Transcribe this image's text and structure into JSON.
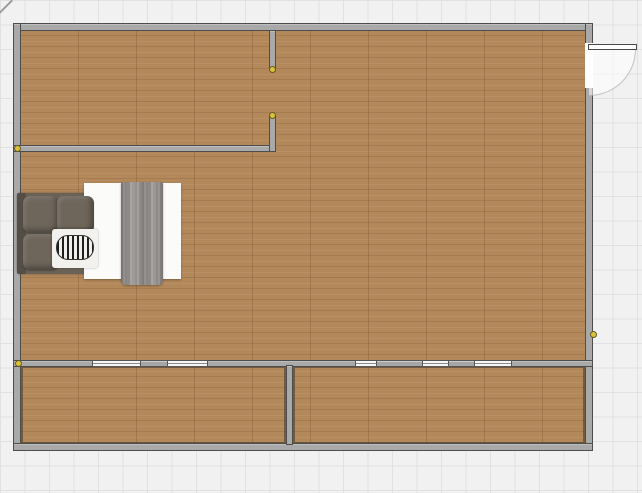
{
  "canvas": {
    "width": 642,
    "height": 493,
    "grid_size": 24.5
  },
  "colors": {
    "grid_bg": "#f1f1f1",
    "grid_line": "#e1e1e1",
    "floor": "#b3885a",
    "wall": "#a9a9a9",
    "wall_outline": "#4d4d4d",
    "window_glass": "#f6f6f6",
    "window_frame": "#565656",
    "window_panel": "#a6a6a6",
    "door_white": "#ffffff",
    "swing": "rgba(255,255,255,0.55)",
    "dot_fill": "#d8c33c",
    "dot_ring": "#6a5a1d",
    "room_outline": "rgba(64,52,36,0.55)",
    "mattress": "#fbfbfa",
    "bed_base": "#6b6257",
    "headboard": "#554e47",
    "pillow": "#6f665b",
    "blanket": "#979390"
  },
  "plan": {
    "floor": {
      "x": 20,
      "y": 30,
      "w": 566,
      "h": 414
    },
    "room_outlines": [
      {
        "x": 21,
        "y": 366,
        "w": 265,
        "h": 78
      },
      {
        "x": 293,
        "y": 366,
        "w": 292,
        "h": 78
      }
    ],
    "walls": [
      {
        "name": "wall-outer-top",
        "x": 13,
        "y": 23,
        "w": 580,
        "h": 8
      },
      {
        "name": "wall-outer-left",
        "x": 13,
        "y": 23,
        "w": 8,
        "h": 428
      },
      {
        "name": "wall-outer-right",
        "x": 585,
        "y": 23,
        "w": 8,
        "h": 428
      },
      {
        "name": "wall-outer-bottom",
        "x": 13,
        "y": 443,
        "w": 580,
        "h": 8
      },
      {
        "name": "wall-partition-top-room",
        "x": 13,
        "y": 145,
        "w": 263,
        "h": 7
      },
      {
        "name": "wall-partition-vertical-upper",
        "x": 269,
        "y": 30,
        "w": 7,
        "h": 40
      },
      {
        "name": "wall-partition-vertical-lower",
        "x": 269,
        "y": 115,
        "w": 7,
        "h": 37
      },
      {
        "name": "wall-window-horizontal",
        "x": 13,
        "y": 360,
        "w": 580,
        "h": 7
      },
      {
        "name": "wall-divider-bottom",
        "x": 286,
        "y": 365,
        "w": 7,
        "h": 80
      }
    ],
    "windows": [
      {
        "x": 92,
        "y": 360,
        "w": 49,
        "h": 7,
        "kind": "glass"
      },
      {
        "x": 140,
        "y": 360,
        "w": 28,
        "h": 7,
        "kind": "panel"
      },
      {
        "x": 167,
        "y": 360,
        "w": 41,
        "h": 7,
        "kind": "glass"
      },
      {
        "x": 355,
        "y": 360,
        "w": 22,
        "h": 7,
        "kind": "glass"
      },
      {
        "x": 376,
        "y": 360,
        "w": 47,
        "h": 7,
        "kind": "panel"
      },
      {
        "x": 422,
        "y": 360,
        "w": 27,
        "h": 7,
        "kind": "glass"
      },
      {
        "x": 448,
        "y": 360,
        "w": 27,
        "h": 7,
        "kind": "panel"
      },
      {
        "x": 474,
        "y": 360,
        "w": 38,
        "h": 7,
        "kind": "glass"
      }
    ],
    "door": {
      "gap": {
        "x": 585,
        "y": 43,
        "w": 8,
        "h": 45
      },
      "leaf": {
        "x": 588,
        "y": 44,
        "w": 49,
        "h": 6
      },
      "swing": {
        "x": 589,
        "y": 49,
        "w": 47,
        "h": 47
      }
    },
    "dots": [
      {
        "x": 17,
        "y": 148
      },
      {
        "x": 272,
        "y": 69
      },
      {
        "x": 272,
        "y": 115
      },
      {
        "x": 18,
        "y": 363
      },
      {
        "x": 593,
        "y": 334
      }
    ],
    "bed": {
      "x": 17,
      "y": 182,
      "w": 164,
      "h": 103,
      "parts": [
        {
          "part": "base",
          "cls": "base",
          "x": 0,
          "y": 11,
          "w": 79,
          "h": 81
        },
        {
          "part": "headboard",
          "cls": "headboard",
          "x": 0,
          "y": 11,
          "w": 9,
          "h": 81
        },
        {
          "part": "mattress",
          "cls": "mattress",
          "x": 67,
          "y": 1,
          "w": 97,
          "h": 96
        },
        {
          "part": "pillow-1",
          "cls": "pillow",
          "x": 6,
          "y": 14,
          "w": 36,
          "h": 37
        },
        {
          "part": "pillow-2",
          "cls": "pillow",
          "x": 40,
          "y": 14,
          "w": 37,
          "h": 37
        },
        {
          "part": "pillow-3",
          "cls": "pillow",
          "x": 6,
          "y": 52,
          "w": 36,
          "h": 36
        },
        {
          "part": "sheet-pillow",
          "cls": "sheet-pillow",
          "x": 35,
          "y": 47,
          "w": 46,
          "h": 39
        },
        {
          "part": "bolster",
          "cls": "bolster",
          "x": 39,
          "y": 53,
          "w": 38,
          "h": 25
        },
        {
          "part": "blanket",
          "cls": "blanket",
          "x": 104,
          "y": 0,
          "w": 42,
          "h": 103
        }
      ]
    }
  }
}
